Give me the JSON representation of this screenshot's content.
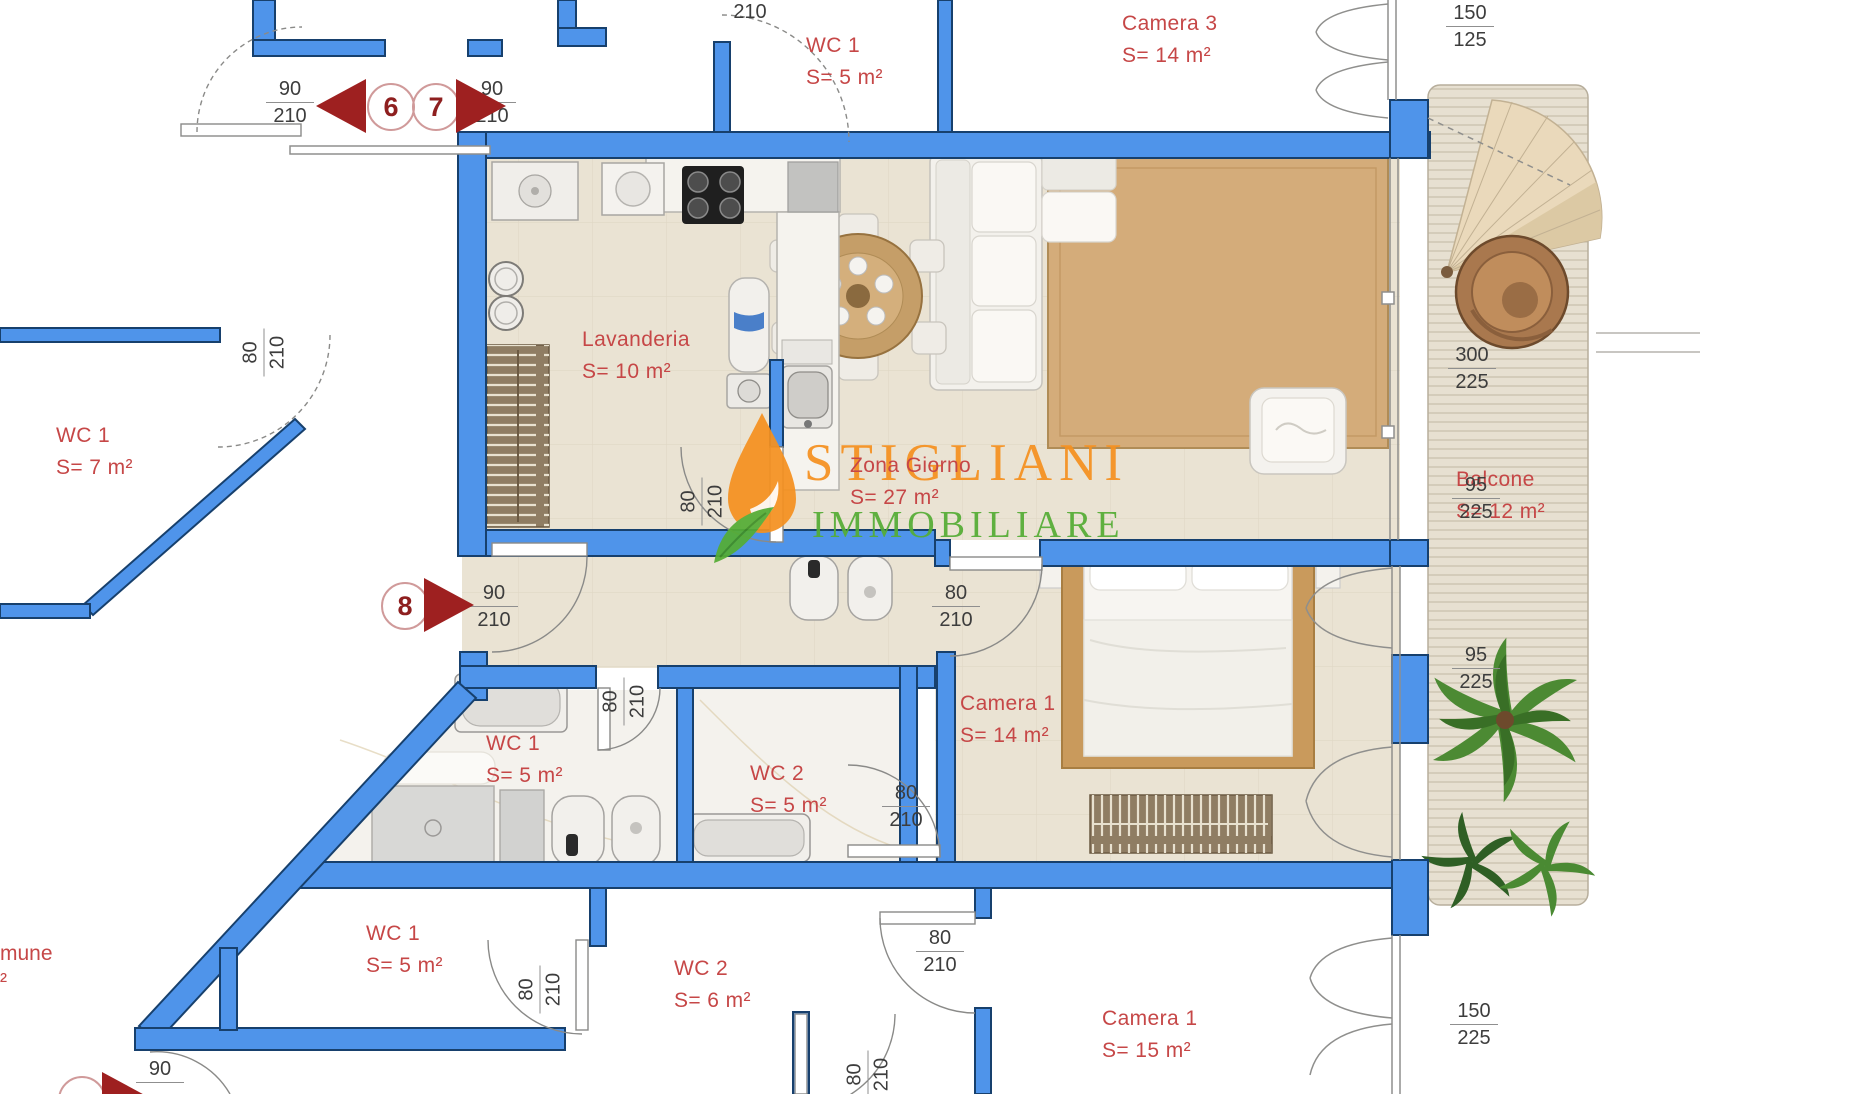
{
  "watermark": {
    "line1": "STIGLIANI",
    "line2": "IMMOBILIARE",
    "color_orange": "#f59120",
    "color_green": "#55ad35"
  },
  "rooms": [
    {
      "name": "WC 1",
      "area": "S= 5 m²"
    },
    {
      "name": "Camera 3",
      "area": "S= 14 m²"
    },
    {
      "name": "WC 1",
      "area": "S= 7 m²"
    },
    {
      "name": "Lavanderia",
      "area": "S= 10 m²"
    },
    {
      "name": "Zona Giorno",
      "area": "S= 27 m²"
    },
    {
      "name": "Balcone",
      "area": "S= 12 m²"
    },
    {
      "name": "Camera 1",
      "area": "S= 14 m²"
    },
    {
      "name": "WC 1",
      "area": "S= 5 m²"
    },
    {
      "name": "WC 2",
      "area": "S= 5 m²"
    },
    {
      "name": "WC 1",
      "area": "S= 5 m²"
    },
    {
      "name": "WC 2",
      "area": "S= 6 m²"
    },
    {
      "name": "Camera 1",
      "area": "S= 15 m²"
    }
  ],
  "fragments": {
    "comune": "mune",
    "comune_sub": "²"
  },
  "dims": [
    {
      "top": "90",
      "bottom": "210"
    },
    {
      "top": "90",
      "bottom": "210"
    },
    {
      "bottom": "210"
    },
    {
      "top": "150",
      "bottom": "125"
    },
    {
      "top": "80",
      "bottom": "210"
    },
    {
      "top": "90",
      "bottom": "210"
    },
    {
      "top": "80",
      "bottom": "210"
    },
    {
      "top": "80",
      "bottom": "210"
    },
    {
      "top": "300",
      "bottom": "225"
    },
    {
      "top": "95",
      "bottom": "225"
    },
    {
      "top": "95",
      "bottom": "225"
    },
    {
      "top": "80",
      "bottom": "210"
    },
    {
      "top": "80",
      "bottom": "210"
    },
    {
      "top": "80",
      "bottom": "210"
    },
    {
      "top": "80",
      "bottom": "210"
    },
    {
      "top": "80",
      "bottom": "210"
    },
    {
      "top": "150",
      "bottom": "225"
    },
    {
      "top": "90"
    }
  ],
  "door_numbers": [
    {
      "n": "6"
    },
    {
      "n": "7"
    },
    {
      "n": "8"
    },
    {
      "n": ""
    }
  ],
  "colors": {
    "wall_blue": "#4f94ea",
    "wall_outline": "#17406d",
    "room_text_red": "#c64747",
    "arrow_red": "#9e2020",
    "floor_beige": "#eae3d3",
    "wood": "#c99a5c"
  }
}
